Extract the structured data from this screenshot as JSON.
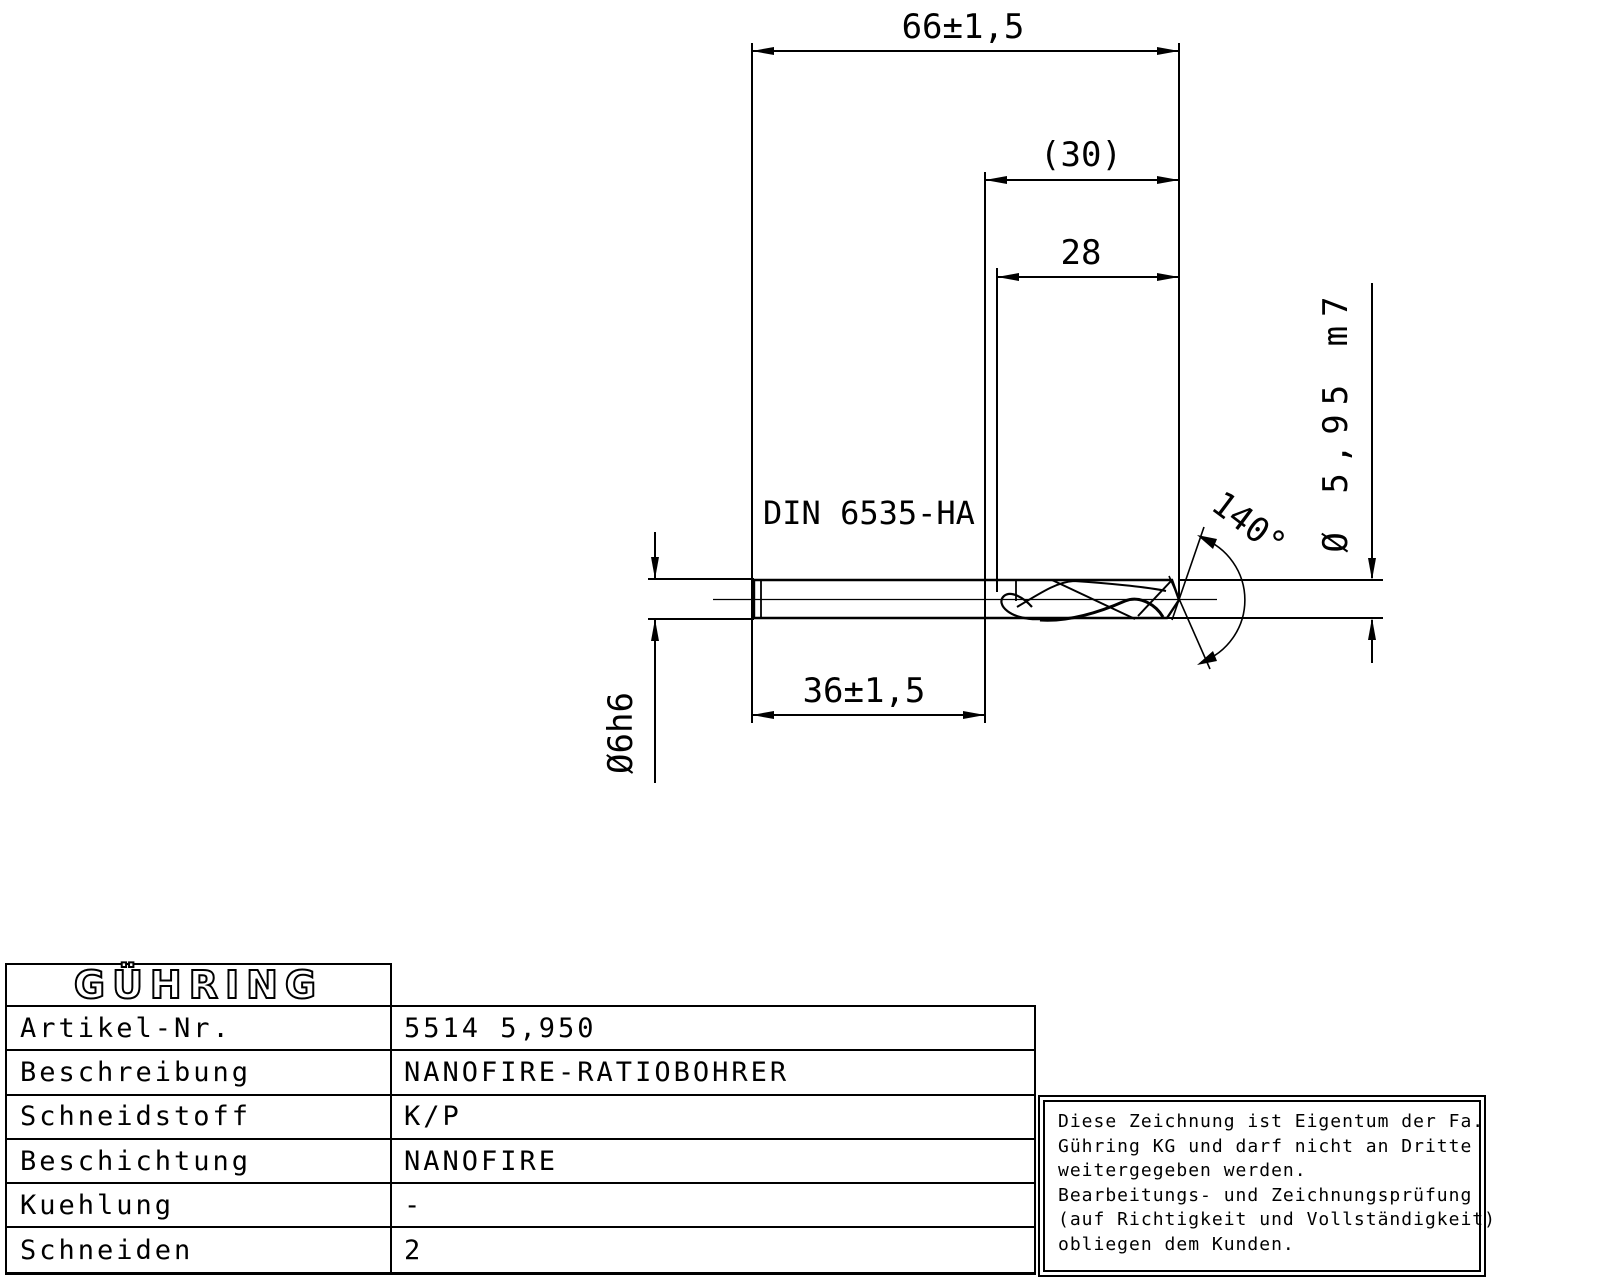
{
  "drawing": {
    "standard_label": "DIN 6535-HA",
    "dimensions": {
      "overall_length": "66±1,5",
      "flute_length_ref": "(30)",
      "flute_length": "28",
      "shank_length": "36±1,5",
      "cutting_diameter": "Ø 5,95 m7",
      "shank_diameter": "Ø6h6",
      "point_angle": "140°"
    }
  },
  "title_block": {
    "logo": "GÜHRING",
    "rows": [
      {
        "label": "Artikel-Nr.",
        "value": "5514 5,950"
      },
      {
        "label": "Beschreibung",
        "value": "NANOFIRE-RATIOBOHRER"
      },
      {
        "label": "Schneidstoff",
        "value": "K/P"
      },
      {
        "label": "Beschichtung",
        "value": "NANOFIRE"
      },
      {
        "label": "Kuehlung",
        "value": "-"
      },
      {
        "label": "Schneiden",
        "value": "2"
      }
    ]
  },
  "disclaimer": {
    "lines": [
      "Diese Zeichnung ist Eigentum der Fa.",
      "Gühring KG und darf nicht an Dritte",
      "weitergegeben werden.",
      "Bearbeitungs- und Zeichnungsprüfung",
      "(auf Richtigkeit und Vollständigkeit)",
      "obliegen dem Kunden."
    ]
  },
  "colors": {
    "ink": "#000000",
    "paper": "#ffffff"
  }
}
